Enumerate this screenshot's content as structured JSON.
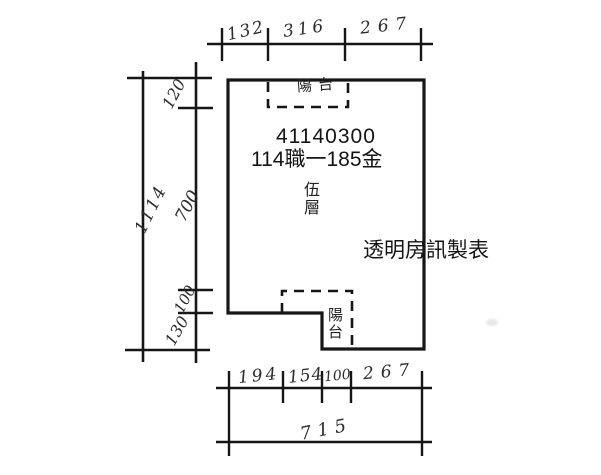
{
  "plan": {
    "property_id": "41140300",
    "case_label": "114職一185金",
    "floor": {
      "char1": "伍",
      "char2": "層"
    },
    "front_annotation": {
      "char1": "陽",
      "char2": "台"
    },
    "balcony": {
      "char1": "陽",
      "char2": "台"
    },
    "publisher": "透明房訊製表"
  },
  "dimensions": {
    "top": {
      "seg1": "132",
      "seg2": "316",
      "seg3": "267"
    },
    "left": {
      "total": "1114",
      "seg1": "120",
      "seg2": "700",
      "seg3": "100",
      "seg4": "130"
    },
    "bottom": {
      "seg1": "194",
      "seg2": "154",
      "seg3": "100",
      "seg4": "267",
      "total": "715"
    }
  },
  "colors": {
    "ink": "#161616",
    "paper": "#ffffff"
  }
}
